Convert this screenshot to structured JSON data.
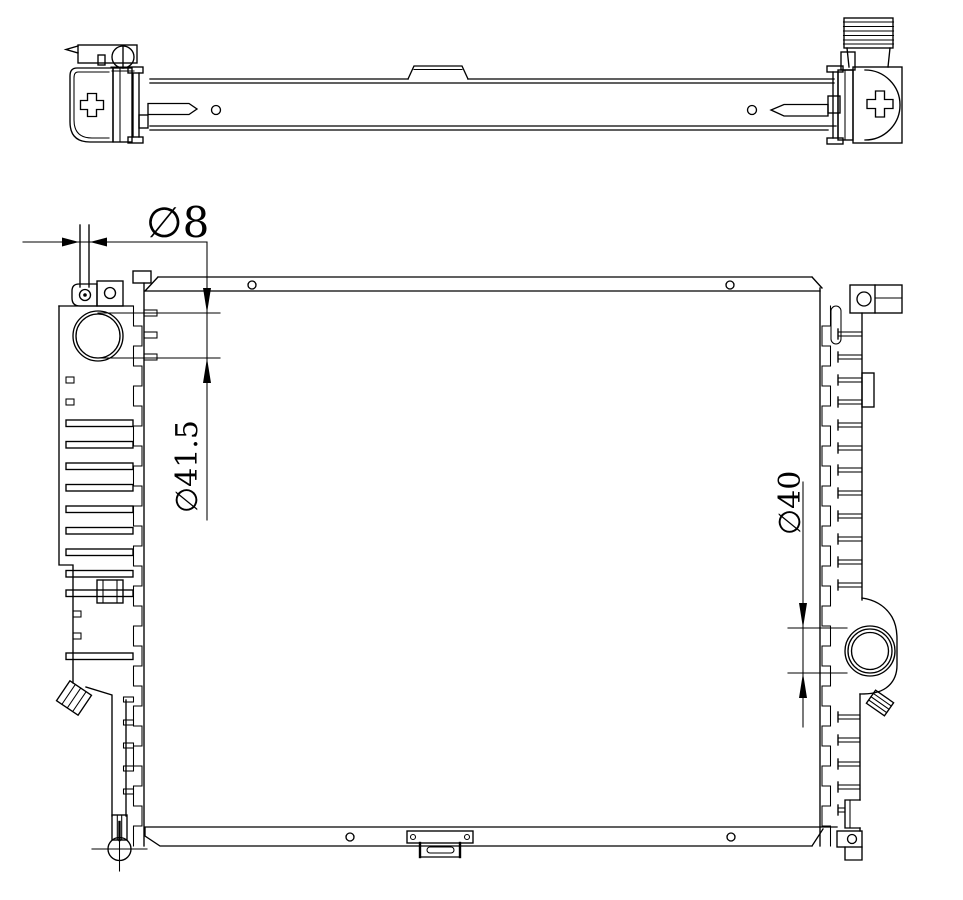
{
  "page": {
    "background": "#ffffff",
    "line_color": "#000000"
  },
  "drawing": {
    "type": "engineering-line-drawing",
    "subject": "automotive radiator — top view and front view",
    "dimensions": [
      {
        "id": "mounting-pin-diameter",
        "label": "∅8",
        "orientation": "horizontal"
      },
      {
        "id": "inlet-port-diameter",
        "label": "∅41.5",
        "orientation": "vertical"
      },
      {
        "id": "outlet-port-diameter",
        "label": "∅40",
        "orientation": "vertical"
      }
    ]
  }
}
